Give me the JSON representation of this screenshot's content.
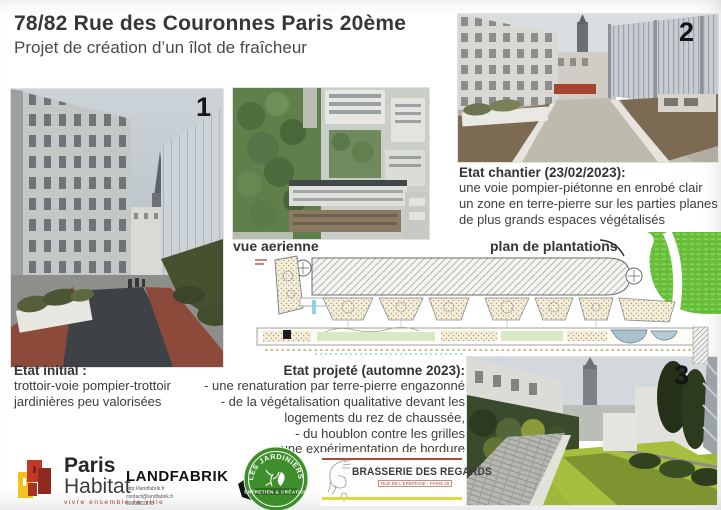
{
  "header": {
    "title": "78/82 Rue des Couronnes Paris 20ème",
    "subtitle": "Projet de création d’un îlot de fraîcheur"
  },
  "labels": {
    "photo1": "1",
    "photo2": "2",
    "photo3": "3"
  },
  "captions": {
    "aerial": "vue aerienne",
    "plan": "plan de plantations"
  },
  "etat_initial": {
    "heading": "Etat initial :",
    "line1": "trottoir-voie pompier-trottoir",
    "line2": "jardinières peu valorisées"
  },
  "etat_chantier": {
    "heading": "Etat chantier (23/02/2023):",
    "line1": "une voie pompier-piétonne en enrobé clair",
    "line2": "un zone en terre-pierre sur les parties planes",
    "line3": "de plus grands espaces végétalisés"
  },
  "etat_projete": {
    "heading": "Etat projeté (automne 2023):",
    "line1": "- une renaturation par terre-pierre engazonné",
    "line2": "- de la végétalisation qualitative devant les",
    "line3": "logements du rez de chaussée,",
    "line4": "- du houblon contre les grilles",
    "line5": "- une expérimentation de bordure d’évaporation"
  },
  "logos": {
    "paris_habitat": {
      "name_line1": "Paris",
      "name_line2": "Habitat",
      "tagline": "vivre ensemble la ville"
    },
    "landfabrik": {
      "name": "LANDFABRIK",
      "url": "http://landfabrik.fr",
      "email": "contact@landfabrik.fr",
      "phone": "0983581378"
    },
    "jardiniers_a_velo": {
      "arc_text": "LES JARDINIERS A VELO",
      "band_text": "ENTRETIEN & CRÉATION"
    },
    "brasserie_des_regards": {
      "name": "BRASSERIE DES REGARDS",
      "subtext": "RUE DE L'ERMITAGE - PARIS 20"
    }
  },
  "colors": {
    "plan_green": "#6cc13b",
    "habitat_red": "#c23a27",
    "habitat_yellow": "#f0c31f",
    "jardiniers_green": "#3f8e2c",
    "brasserie_red": "#ad4a3e",
    "brasserie_yellow": "#e3d63e"
  }
}
